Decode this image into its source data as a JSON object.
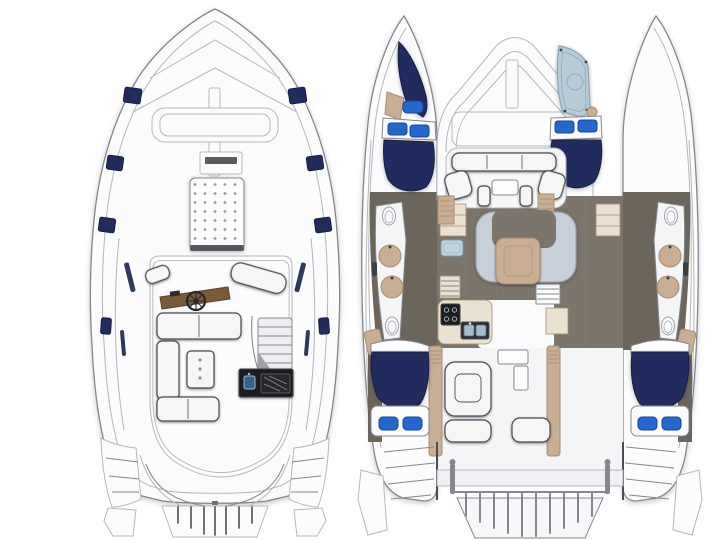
{
  "page": {
    "background": "#ffffff"
  },
  "colors": {
    "background": "#ffffff",
    "line": "#b3b7bc",
    "line_strong": "#83878d",
    "ink": "#3c3f44",
    "deck": "#fcfcfd",
    "deck_shade": "#eceef0",
    "seat": "#f6f6f4",
    "seat_edge": "#4a4d52",
    "navy": "#222b5e",
    "navy_dark": "#161d45",
    "hatch_blue": "#2268cf",
    "hatch_blue_dark": "#12459c",
    "shower_blue": "#b7ccd8",
    "shower_edge": "#8aa6b6",
    "tan": "#c9ae93",
    "tan_dark": "#a88c6f",
    "cream": "#e9e1d2",
    "floor": "#7c756b",
    "floor_dark": "#6b655c",
    "wood_helm": "#7a5a38",
    "module_dark": "#1b1c1f",
    "steel": "#a9bcc9",
    "settee": "#c9cfd8",
    "settee_edge": "#9aa3ae"
  },
  "diagram": {
    "type": "catamaran-yacht-deck-plan",
    "orientation": "bow-up",
    "views": [
      {
        "name": "upper-deck-flybridge",
        "position": "left",
        "features": [
          "foredeck-sun-pad",
          "helm-station",
          "steering-wheel",
          "helm-bench",
          "u-shaped-settee",
          "cocktail-table",
          "stairway",
          "wet-bar-grill-sink",
          "deck-hatches",
          "side-windows",
          "stern-steps",
          "transom-platform",
          "stern-rail"
        ]
      },
      {
        "name": "main-deck-interior",
        "position": "right",
        "features": [
          "port-forward-berth",
          "starboard-forward-shower",
          "berth-pillows",
          "forward-cockpit-seating",
          "saloon-u-settee",
          "saloon-table",
          "galley-stove",
          "galley-double-sink",
          "refrigerator",
          "port-head-vanity",
          "starboard-head-vanity",
          "toilets",
          "washbasins",
          "companionway-steps",
          "aft-cockpit-seating",
          "aft-cabin-berths",
          "davit-rail",
          "swim-platform",
          "stern-steps"
        ]
      }
    ]
  }
}
